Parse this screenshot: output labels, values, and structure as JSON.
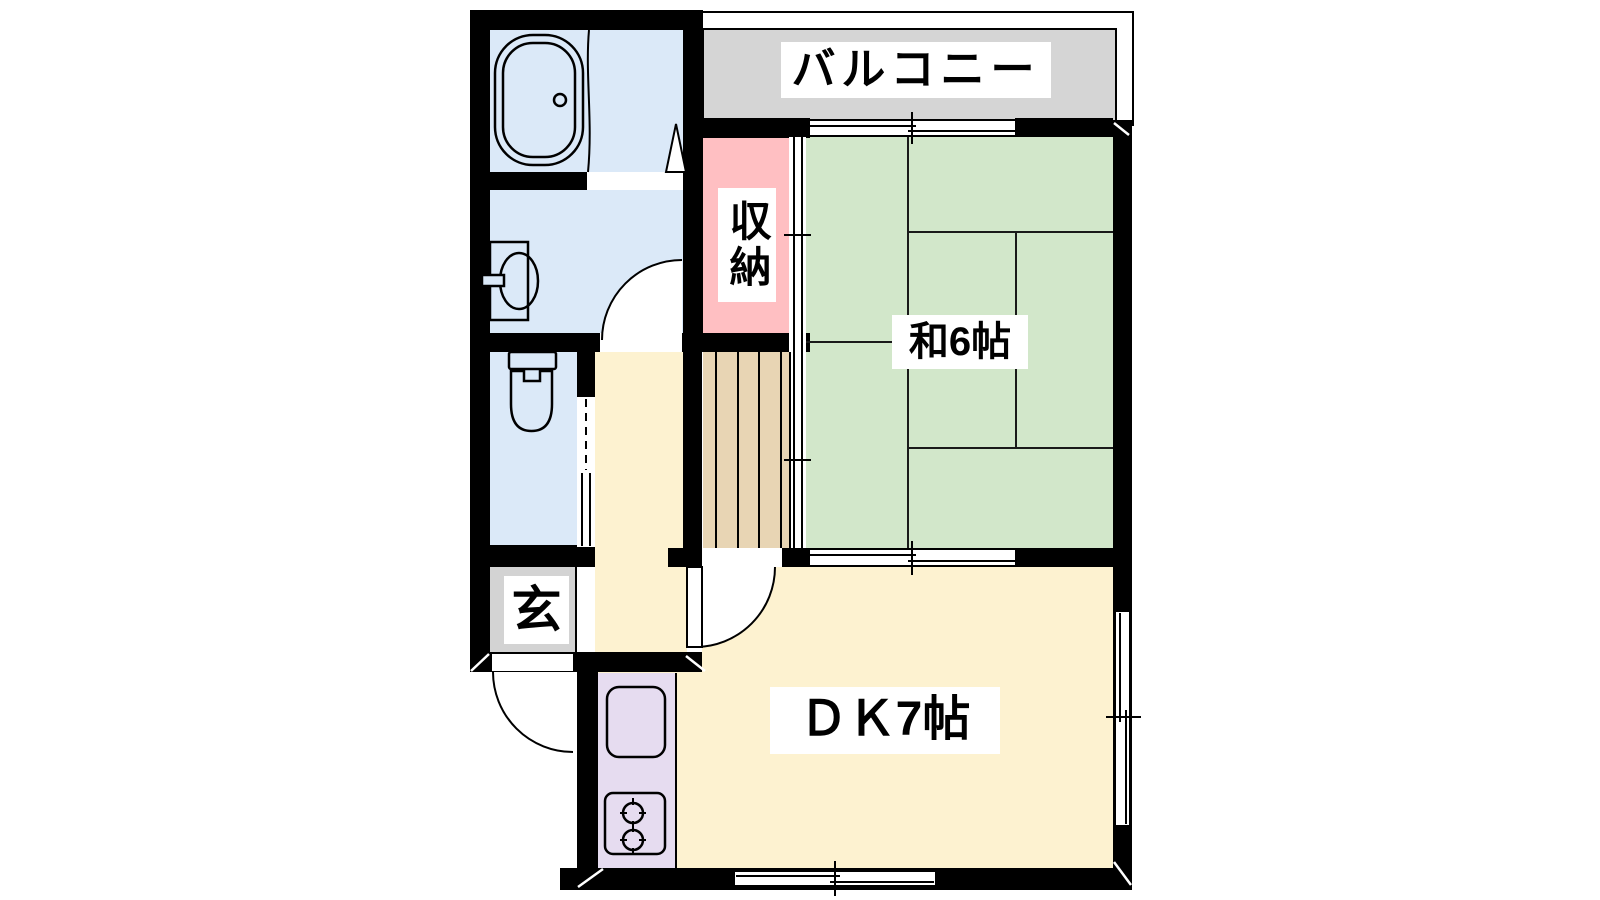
{
  "rooms": {
    "balcony": {
      "label": "バルコニー"
    },
    "japanese_room": {
      "label": "和6帖"
    },
    "closet": {
      "label": "収納"
    },
    "dining_kitchen": {
      "label": "ＤＫ7帖"
    },
    "entrance": {
      "label": "玄"
    }
  },
  "fixtures": [
    "bathtub-icon",
    "bath-partition-icon",
    "bath-door-triangle-icon",
    "vanity-basin-icon",
    "toilet-icon",
    "kitchen-sink-icon",
    "gas-stove-2-burner-icon",
    "staircase-icon",
    "tatami-6-mat-grid",
    "sliding-window-icon",
    "sliding-door-icon",
    "hinged-door-arc-icon"
  ],
  "colors": {
    "wall": "#000000",
    "water_room": "#dbe9f8",
    "closet": "#ffbfc2",
    "tatami": "#d2e7ca",
    "living": "#fdf2d0",
    "stairs": "#e8d5b4",
    "kitchen_counter": "#e6dcf0",
    "balcony": "#d5d5d5",
    "entrance_floor": "#d3d3d3",
    "label_bg": "#ffffff",
    "label_text": "#000000"
  }
}
